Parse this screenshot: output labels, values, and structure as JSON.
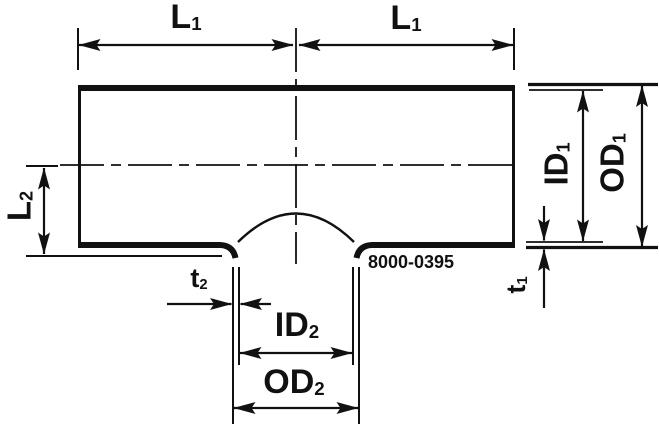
{
  "drawing": {
    "title_hint": "Reducing tee pipe fitting cross-section",
    "part_number": "8000-0395",
    "colors": {
      "line": "#111111",
      "background": "#ffffff"
    },
    "labels": {
      "l1_left": {
        "base": "L",
        "sub": "1"
      },
      "l1_right": {
        "base": "L",
        "sub": "1"
      },
      "l2": {
        "base": "L",
        "sub": "2"
      },
      "id1": {
        "base": "ID",
        "sub": "1"
      },
      "od1": {
        "base": "OD",
        "sub": "1"
      },
      "t1": {
        "base": "t",
        "sub": "1"
      },
      "t2": {
        "base": "t",
        "sub": "2"
      },
      "id2": {
        "base": "ID",
        "sub": "2"
      },
      "od2": {
        "base": "OD",
        "sub": "2"
      }
    }
  }
}
